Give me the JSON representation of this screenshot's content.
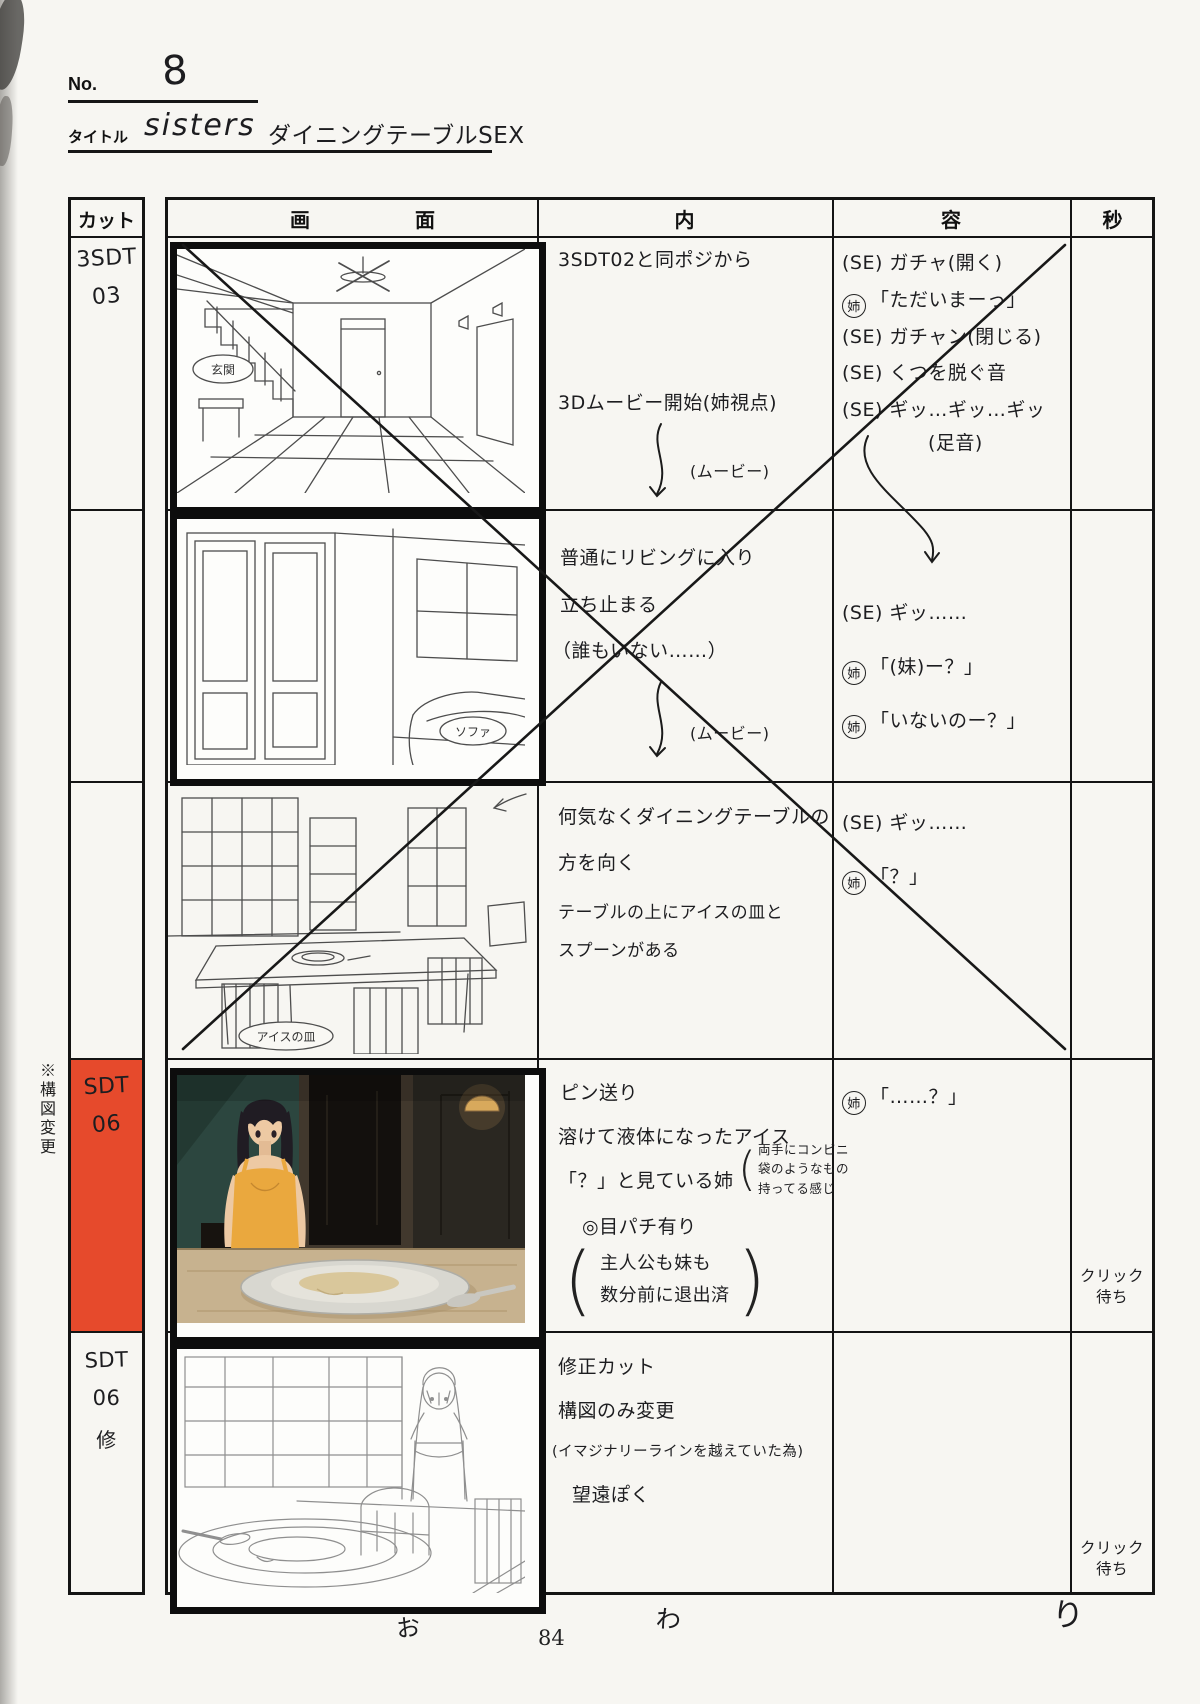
{
  "page": {
    "no_label": "No.",
    "no_value": "8",
    "title_label": "タイトル",
    "title_latin": "sisters",
    "title_kana": "ダイニングテーブルSEX",
    "side_note": "※構図変更",
    "ending_chars": [
      "お",
      "わ",
      "り"
    ],
    "page_number": "84"
  },
  "header": {
    "cut": "カット",
    "screen_a": "画",
    "screen_b": "面",
    "inner": "内",
    "outer": "容",
    "seconds": "秒"
  },
  "colors": {
    "highlight_red": "#e64a2c"
  },
  "rows": [
    {
      "cut_lines": [
        "3SDT",
        "03"
      ],
      "sketch_label": "玄関",
      "action": [
        "3SDT02と同ポジから",
        "3Dムービー開始(姉視点)",
        "(ムービー)"
      ],
      "sound": [
        {
          "s": "",
          "t": "(SE) ガチャ(開く)"
        },
        {
          "s": "姉",
          "t": "「ただいまーっ」"
        },
        {
          "s": "",
          "t": "(SE) ガチャン(閉じる)"
        },
        {
          "s": "",
          "t": "(SE) くつを脱ぐ音"
        },
        {
          "s": "",
          "t": "(SE) ギッ…ギッ…ギッ"
        },
        {
          "s": "",
          "t": "(足音)"
        }
      ]
    },
    {
      "sketch_label": "ソファ",
      "action": [
        "普通にリビングに入り",
        "立ち止まる",
        "（誰もいない……）",
        "(ムービー)"
      ],
      "sound": [
        {
          "s": "",
          "t": "(SE) ギッ……"
        },
        {
          "s": "姉",
          "t": "「(妹)ー？」"
        },
        {
          "s": "姉",
          "t": "「いないのー？」"
        }
      ]
    },
    {
      "sketch_label": "アイスの皿",
      "action": [
        "何気なくダイニングテーブルの",
        "方を向く",
        "テーブルの上にアイスの皿と",
        "スプーンがある"
      ],
      "sound": [
        {
          "s": "",
          "t": "(SE) ギッ……"
        },
        {
          "s": "姉",
          "t": "「？」"
        }
      ]
    },
    {
      "cut_lines": [
        "SDT",
        "06"
      ],
      "action": [
        "ピン送り",
        "溶けて液体になったアイス",
        "「？」と見ている姉",
        "◎目パチ有り"
      ],
      "note_small": [
        "両手にコンビニ",
        "袋のようなもの",
        "持ってる感じ"
      ],
      "note_paren": [
        "主人公も妹も",
        "数分前に退出済"
      ],
      "sound": [
        {
          "s": "姉",
          "t": "「……？」"
        }
      ],
      "seconds": "クリック待ち"
    },
    {
      "cut_lines": [
        "SDT",
        "06",
        "修"
      ],
      "action": [
        "修正カット",
        "構図のみ変更",
        "(イマジナリーラインを越えていた為)",
        "望遠ぽく"
      ],
      "sound": [],
      "seconds": "クリック待ち"
    }
  ]
}
